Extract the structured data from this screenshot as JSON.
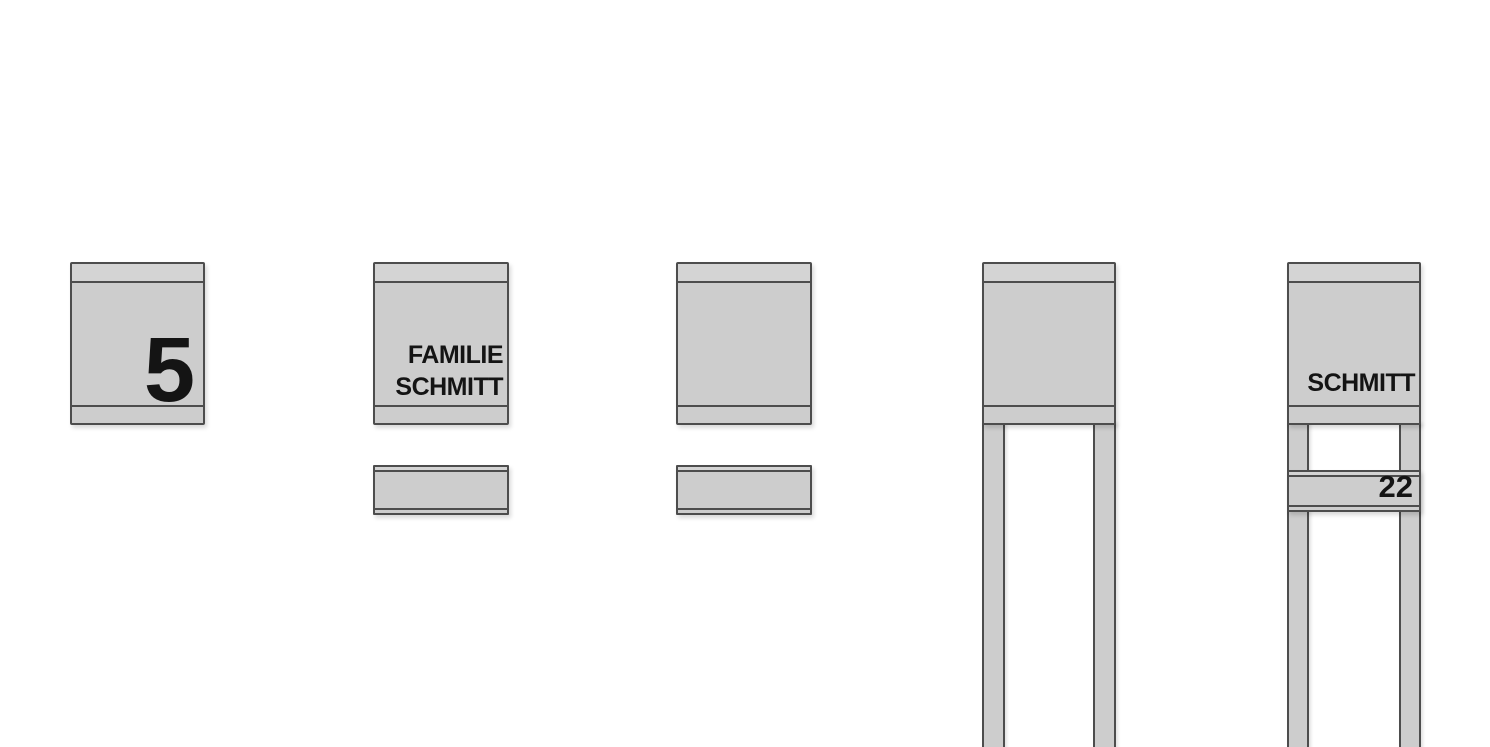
{
  "canvas": {
    "width": 1490,
    "height": 747,
    "background": "#ffffff"
  },
  "colors": {
    "fill": "#cdcdcd",
    "fill_light": "#d4d4d4",
    "line": "#4d4d4d",
    "text": "#141414"
  },
  "items": [
    {
      "id": "wall-box-with-number",
      "label": "5"
    },
    {
      "id": "wall-box-with-name-and-plate",
      "label": "FAMILIE\nSCHMITT"
    },
    {
      "id": "wall-box-plain-with-plate",
      "label": ""
    },
    {
      "id": "stand-box-plain",
      "label": ""
    },
    {
      "id": "stand-box-with-name-and-number",
      "name_label": "SCHMITT",
      "number_label": "22"
    }
  ]
}
